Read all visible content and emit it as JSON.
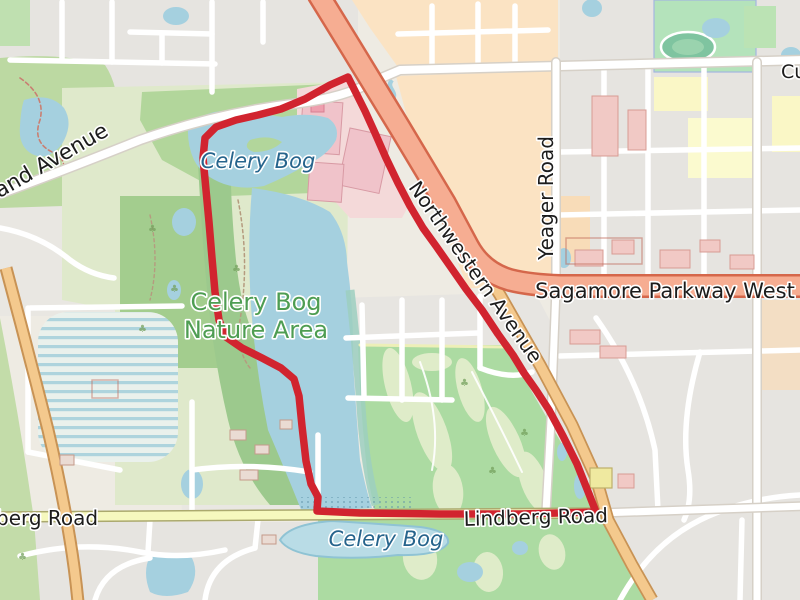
{
  "map": {
    "description": "OpenStreetMap-style map with red GPS route loop around Celery Bog Nature Area",
    "labels": {
      "cumberland_left": "land Avenue",
      "cumberland_right": "Cum",
      "celery_bog_top": "Celery Bog",
      "nature_area_line1": "Celery Bog",
      "nature_area_line2": "Nature Area",
      "northwestern": "Northwestern Avenue",
      "yeager": "Yeager Road",
      "sagamore": "Sagamore Parkway West",
      "lindberg": "Lindberg Road",
      "lindberg_left": "berg Road",
      "celery_bog_bottom": "Celery Bog"
    },
    "route": {
      "color": "#d1242f",
      "width": 7.5,
      "path_d": "M 348 77 L 330 85 L 305 99 L 281 109 L 258 115 L 236 120 L 216 127 L 205 138 L 203 158 L 206 190 L 209 222 L 212 258 L 215 292 L 219 320 L 226 337 L 242 348 L 262 358 L 281 368 L 294 379 L 299 396 L 302 426 L 306 461 L 311 484 L 318 497 L 317 511 L 360 513 L 440 514 L 520 514 L 596 512 L 589 494 L 577 464 L 563 436 L 549 410 L 536 390 L 524 373 L 513 355 L 498 334 L 482 310 L 466 289 L 450 266 L 436 246 L 423 228 L 410 206 L 398 183 L 386 158 L 375 133 L 365 111 L 356 93 Z"
    },
    "colors": {
      "water": "#a5d0df",
      "forest": "#a3cd8e",
      "golf": "#acdba2",
      "trunk_road": "#f6ad92",
      "primary_road": "#f4c98d",
      "secondary_road": "#f6f8be",
      "retail_pink": "#f4d9d9",
      "commercial_peach": "#fbe3c3",
      "residential_gray": "#e6e4e0"
    }
  }
}
